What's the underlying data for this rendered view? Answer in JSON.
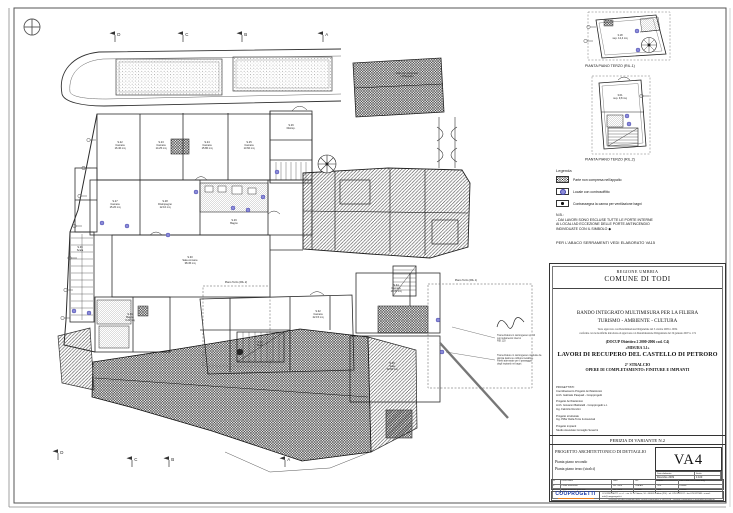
{
  "sheet": {
    "type": "architectural drawing",
    "paper_color": "#ffffff"
  },
  "colors": {
    "line": "#2b2b2b",
    "ceiling_marker": "#8c8cd8",
    "logo_blue": "#1b3aa8",
    "logo_orange": "#e87d1e"
  },
  "north_icon": "compass-cross",
  "plan": {
    "sections": {
      "top": [
        {
          "x": 115,
          "y": 38,
          "label": "D"
        },
        {
          "x": 183,
          "y": 38,
          "label": "C"
        },
        {
          "x": 242,
          "y": 38,
          "label": "B"
        },
        {
          "x": 323,
          "y": 38,
          "label": "A"
        }
      ],
      "bottom": [
        {
          "x": 58,
          "y": 456,
          "label": "D"
        },
        {
          "x": 132,
          "y": 463,
          "label": "C"
        },
        {
          "x": 169,
          "y": 463,
          "label": "B"
        },
        {
          "x": 285,
          "y": 463,
          "label": "A"
        }
      ]
    },
    "ceiling_markers": [
      [
        102,
        223
      ],
      [
        127,
        226
      ],
      [
        74,
        311
      ],
      [
        89,
        313
      ],
      [
        196,
        192
      ],
      [
        233,
        208
      ],
      [
        248,
        210
      ],
      [
        277,
        172
      ],
      [
        263,
        197
      ],
      [
        168,
        235
      ],
      [
        438,
        320
      ],
      [
        442,
        352
      ],
      [
        637,
        31
      ],
      [
        638,
        50
      ],
      [
        627,
        116
      ],
      [
        629,
        124
      ]
    ],
    "window_marks": [
      [
        93,
        140
      ],
      [
        88,
        168
      ],
      [
        84,
        196
      ],
      [
        79,
        226
      ],
      [
        74,
        258
      ],
      [
        70,
        290
      ],
      [
        67,
        318
      ],
      [
        593,
        27
      ],
      [
        590,
        41
      ],
      [
        646,
        96
      ]
    ],
    "room_labels": [
      {
        "x": 120,
        "y": 143,
        "lines": [
          "S.22",
          "Camera",
          "16.40 mq"
        ]
      },
      {
        "x": 161,
        "y": 143,
        "lines": [
          "S.23",
          "Camera",
          "14.25 mq"
        ]
      },
      {
        "x": 207,
        "y": 143,
        "lines": [
          "S.24",
          "Camera",
          "15.80 mq"
        ]
      },
      {
        "x": 249,
        "y": 143,
        "lines": [
          "S.25",
          "Camera",
          "13.60 mq"
        ]
      },
      {
        "x": 291,
        "y": 126,
        "lines": [
          "S.26",
          "Disimp."
        ]
      },
      {
        "x": 115,
        "y": 202,
        "lines": [
          "S.27",
          "Camera",
          "15.20 mq"
        ]
      },
      {
        "x": 165,
        "y": 202,
        "lines": [
          "S.28",
          "Disimpegno",
          "12.10 mq"
        ]
      },
      {
        "x": 234,
        "y": 221,
        "lines": [
          "S.29",
          "Bagno"
        ]
      },
      {
        "x": 190,
        "y": 258,
        "lines": [
          "S.30",
          "Sala comune",
          "38.45 mq"
        ]
      },
      {
        "x": 130,
        "y": 315,
        "lines": [
          "S.31",
          "Bagno",
          "6.20 mq"
        ]
      },
      {
        "x": 318,
        "y": 312,
        "lines": [
          "S.32",
          "Camera",
          "22.15 mq"
        ]
      },
      {
        "x": 260,
        "y": 343,
        "lines": [
          "S.33",
          "Scala"
        ]
      },
      {
        "x": 396,
        "y": 286,
        "lines": [
          "S.34",
          "Camera",
          "19.30 mq"
        ]
      },
      {
        "x": 392,
        "y": 364,
        "lines": [
          "S.35",
          "Sala",
          "34.60 mq"
        ]
      },
      {
        "x": 80,
        "y": 248,
        "lines": [
          "S.36",
          "Scala"
        ]
      },
      {
        "x": 407,
        "y": 74,
        "lines": [
          "tetto non compreso",
          "nell'appalto"
        ]
      },
      {
        "x": 620,
        "y": 36,
        "lines": [
          "3.18",
          "sup. 12,4 mq"
        ]
      },
      {
        "x": 620,
        "y": 96,
        "lines": [
          "3.01",
          "sup. 9,8 mq"
        ]
      },
      {
        "x": 236,
        "y": 283,
        "lines": [
          "Piano Terzo (RIL.2)"
        ]
      },
      {
        "x": 466,
        "y": 281,
        "lines": [
          "Piano Terzo (RIL.1)"
        ]
      }
    ],
    "annotations": [
      {
        "x": 497,
        "y": 336,
        "lx1": 495,
        "ly1": 338,
        "lx2": 452,
        "ly2": 327,
        "lines": [
          "Tramezzatura in cartongesso sp. 10",
          "con isolamento interno",
          "REI 120"
        ]
      },
      {
        "x": 497,
        "y": 356,
        "lx1": 495,
        "ly1": 360,
        "lx2": 446,
        "ly2": 352,
        "lines": [
          "Tramezzature in cartongesso costituite da",
          "doppia lastra su orditura metallica.",
          "Pareti attrezzate per il passaggio",
          "degli impianti nei bagni."
        ]
      }
    ]
  },
  "mini_plans": [
    {
      "label": "PIANTA PIANO TERZO (RIL.1)"
    },
    {
      "label": "PIANTA PIANO TERZO (RIL.2)"
    }
  ],
  "legend": {
    "title": "Legenda",
    "items": [
      {
        "swatch": "crosshatch",
        "label": "Parte non compresa nell'appalto"
      },
      {
        "swatch": "blue-dot",
        "label": "Locale con controsoffitto"
      },
      {
        "swatch": "black-dot",
        "label": "Contrassegna la canna per ventilazione bagni"
      }
    ],
    "nb_title": "N.B.:",
    "nb_line1": "- DAI LAVORI SONO ESCLUSE TUTTE LE PORTE INTERNE",
    "nb_line2": "AI LOCALI AD ECCEZIONE DELLE PORTE ANTINCENDIO",
    "nb_line3": "INDIVIDUATE CON IL SIMBOLO ◆",
    "footer": "PER L'ABACO SERRAMENTI VEDI ELABORATO VA15"
  },
  "title_block": {
    "region": "REGIONE UMBRIA",
    "municipality": "COMUNE DI TODI",
    "program_line1": "BANDO INTEGRATO MULTIMISURA PER LA FILIERA",
    "program_line2": "TURISMO - AMBIENTE - CULTURA",
    "small_note1": "Testo approvato con Determinazione Dirigenziale del 3 ottobre 2005 n. 9054",
    "small_note2": "conforme con le modifiche introdotte ed approvate con Determinazione Dirigenziale del 19 gennaio 2007 n. 174",
    "docup": "(DOCUP Obiettivo 2 2000-2006 cod. C4)",
    "misura": "«MISURA 3.1»",
    "project_title": "LAVORI DI RECUPERO DEL CASTELLO DI PETRORO",
    "stralcio": "2° STRALCIO",
    "opere": "OPERE DI COMPLETAMENTO: FINITURE E IMPIANTI",
    "credits": [
      "PROGETTISTI:",
      "Coordinamento Progetto Architettonico",
      "Arch. Gabriele Pasquali - Coopprogetti",
      "",
      "Progetto Architettonico",
      "Arch. Giovanni Battistelli - Coopprogetti s.c.",
      "Ing. Fabrizio Renzini",
      "",
      "Progetto strutturale",
      "Ing. Piffer Della Torre & Associati",
      "",
      "Progetto impianti",
      "Studio Associato Consiglio Severini"
    ],
    "perizia": "PERIZIA DI VARIANTE N.2",
    "progetto": "PROGETTO ARCHITETTONICO DI DETTAGLIO",
    "drawing_line1": "Pianta piano secondo",
    "drawing_line2": "Pianta piano terzo (stralci)",
    "code": "VA4",
    "date_label": "Data elaborato",
    "date_value": "Dicembre 2009",
    "scale_label": "Scala",
    "scale_value": "1:100",
    "revisions": {
      "header": [
        "N.",
        "Descrizione",
        "Data",
        "Dis.",
        "Contr.",
        "File: 7388.PRG.VA04.dwg"
      ],
      "rows": [
        [
          "0",
          "Prima emissione",
          "Dic. 2009",
          "Cod.Arc",
          "G.B.",
          "F.Renz."
        ],
        [
          "1",
          "Aggiornamento generale",
          "Dic. 2009",
          "0/1468",
          "G.B.",
          "F.Renz."
        ]
      ]
    },
    "logo_text": "COOPROGETTI",
    "company_line1": "COOPROGETTI s.c.r.l. - via G. Di Vittorio, 10 - 06024 Gubbio (PG) - tel. 075.9221197 - fax 075.927588 - e-mail: info@coopprogetti.it",
    "company_line2": "iscrizione all'albo nazionale delle società cooperative n. A126518 - sezione cooperative a mutualità prevalente"
  }
}
